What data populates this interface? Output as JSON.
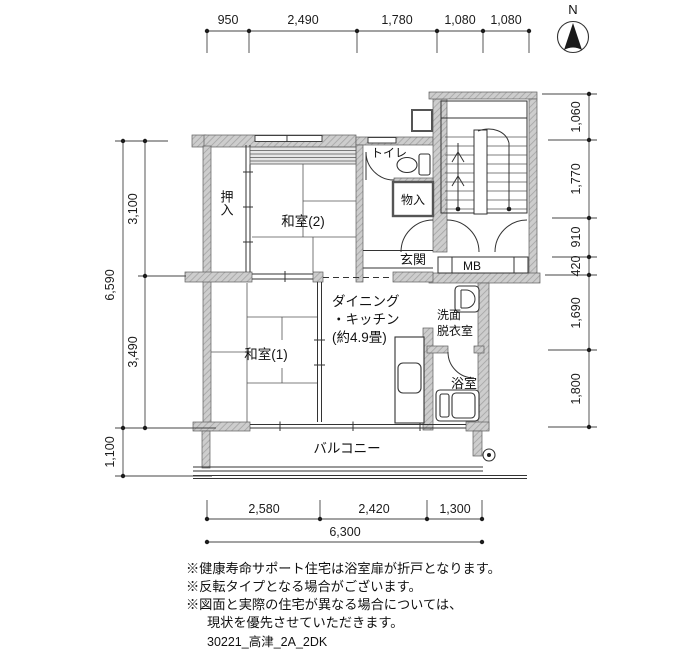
{
  "north": {
    "label": "N"
  },
  "rooms": {
    "oshiire": "押入",
    "washitsu2": "和室(2)",
    "toilet": "トイレ",
    "storage": "物入",
    "genkan": "玄関",
    "meter_box": "MB",
    "dk": [
      "ダイニング",
      "・キッチン",
      "(約4.9畳)"
    ],
    "senmen": [
      "洗面",
      "脱衣室"
    ],
    "washitsu1": "和室(1)",
    "bath": "浴室",
    "balcony": "バルコニー"
  },
  "dimensions": {
    "top": [
      "950",
      "2,490",
      "1,780",
      "1,080",
      "1,080"
    ],
    "left_outer": [
      "6,590",
      "1,100"
    ],
    "left_inner": [
      "3,100",
      "3,490"
    ],
    "right": [
      "1,060",
      "1,770",
      "910",
      "420",
      "1,690",
      "1,800"
    ],
    "bottom": [
      "2,580",
      "2,420",
      "1,300"
    ],
    "bottom_total": "6,300"
  },
  "notes": [
    "※健康寿命サポート住宅は浴室扉が折戸となります。",
    "※反転タイプとなる場合がございます。",
    "※図面と実際の住宅が異なる場合については、",
    "現状を優先させていただきます。"
  ],
  "plan_id": "30221_高津_2A_2DK",
  "colors": {
    "wall_fill": "#cdcdcd",
    "line": "#333333",
    "text": "#111111"
  }
}
